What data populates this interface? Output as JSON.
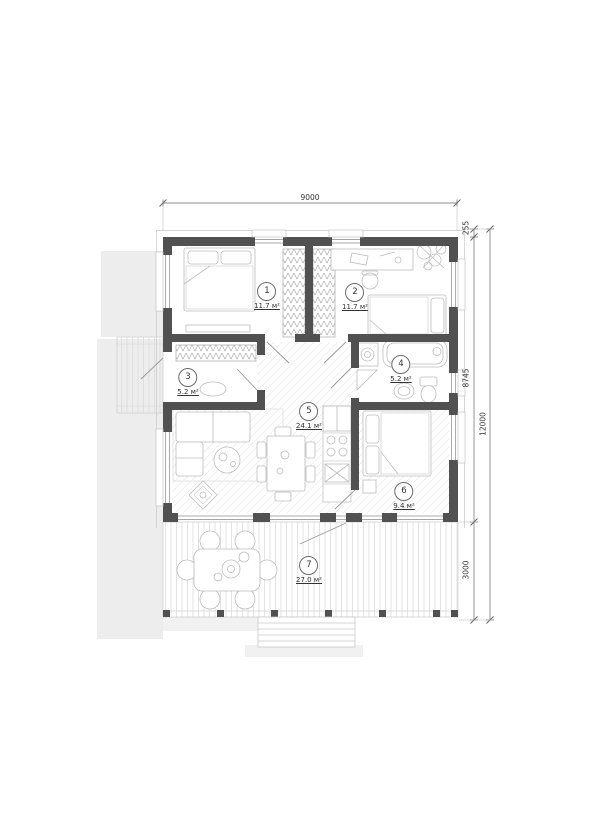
{
  "plan": {
    "rooms": [
      {
        "number": "1",
        "area": "11.7 м²"
      },
      {
        "number": "2",
        "area": "11.7 м²"
      },
      {
        "number": "3",
        "area": "5.2 м²"
      },
      {
        "number": "4",
        "area": "5.2 м²"
      },
      {
        "number": "5",
        "area": "24.1 м²"
      },
      {
        "number": "6",
        "area": "9.4 м²"
      },
      {
        "number": "7",
        "area": "27.0 м²"
      }
    ],
    "dims": {
      "width": "9000",
      "total_height": "12000",
      "overhang": "255",
      "house_depth": "8745",
      "terrace_depth": "3000"
    },
    "colors": {
      "wall": "#515151",
      "shadow": "#ededed",
      "hatch": "#ececec"
    }
  }
}
